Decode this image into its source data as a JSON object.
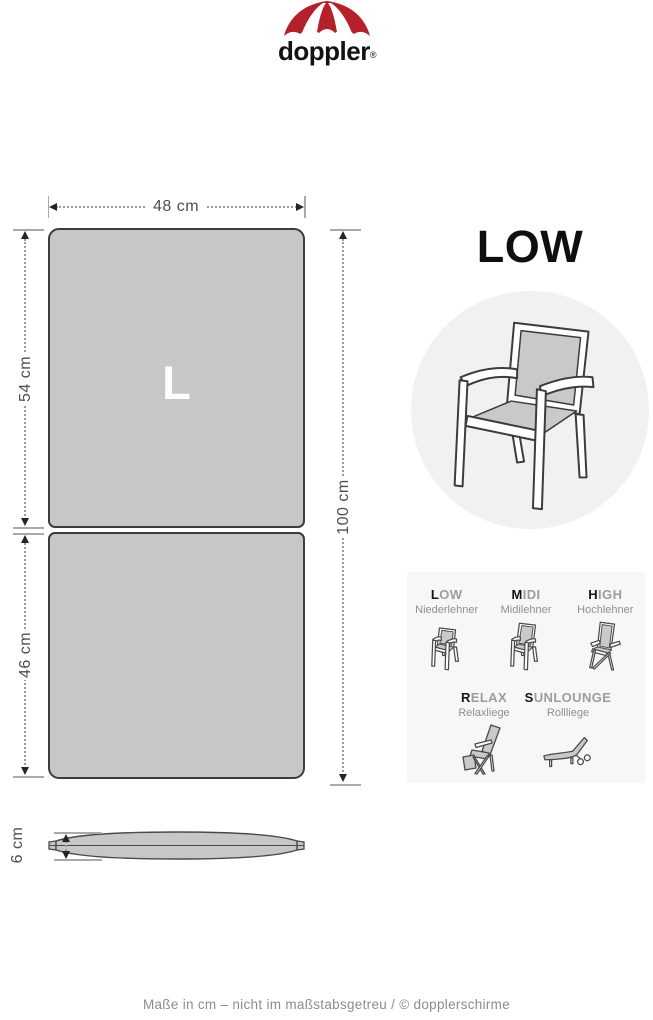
{
  "logo": {
    "brand": "doppler",
    "registered": "®"
  },
  "product": {
    "title": "LOW"
  },
  "diagram": {
    "size_letter": "L",
    "width_label": "48 cm",
    "back_section_label": "54 cm",
    "seat_section_label": "46 cm",
    "total_length_label": "100 cm",
    "thickness_label": "6 cm"
  },
  "type_grid": {
    "row1": [
      {
        "name": "LOW",
        "first": "L",
        "rest": "OW",
        "sub": "Niederlehner",
        "icon": "chair-low-icon"
      },
      {
        "name": "MIDI",
        "first": "M",
        "rest": "IDI",
        "sub": "Midilehner",
        "icon": "chair-midi-icon"
      },
      {
        "name": "HIGH",
        "first": "H",
        "rest": "IGH",
        "sub": "Hochlehner",
        "icon": "chair-high-icon"
      }
    ],
    "row2": [
      {
        "name": "RELAX",
        "first": "R",
        "rest": "ELAX",
        "sub": "Relaxliege",
        "icon": "recliner-icon"
      },
      {
        "name": "SUNLOUNGE",
        "first": "S",
        "rest": "UNLOUNGE",
        "sub": "Rollliege",
        "icon": "sunlounger-icon"
      }
    ]
  },
  "footer": {
    "note": "Maße in cm – nicht im maßstabsgetreu / © dopplerschirme"
  },
  "colors": {
    "brand_red": "#b5212b",
    "cushion_fill": "#c7c7c7",
    "outline": "#3c3c3c",
    "circle_bg": "#f1f1f1",
    "panel_bg": "#f7f7f7",
    "dim_text": "#4f4f4f"
  }
}
